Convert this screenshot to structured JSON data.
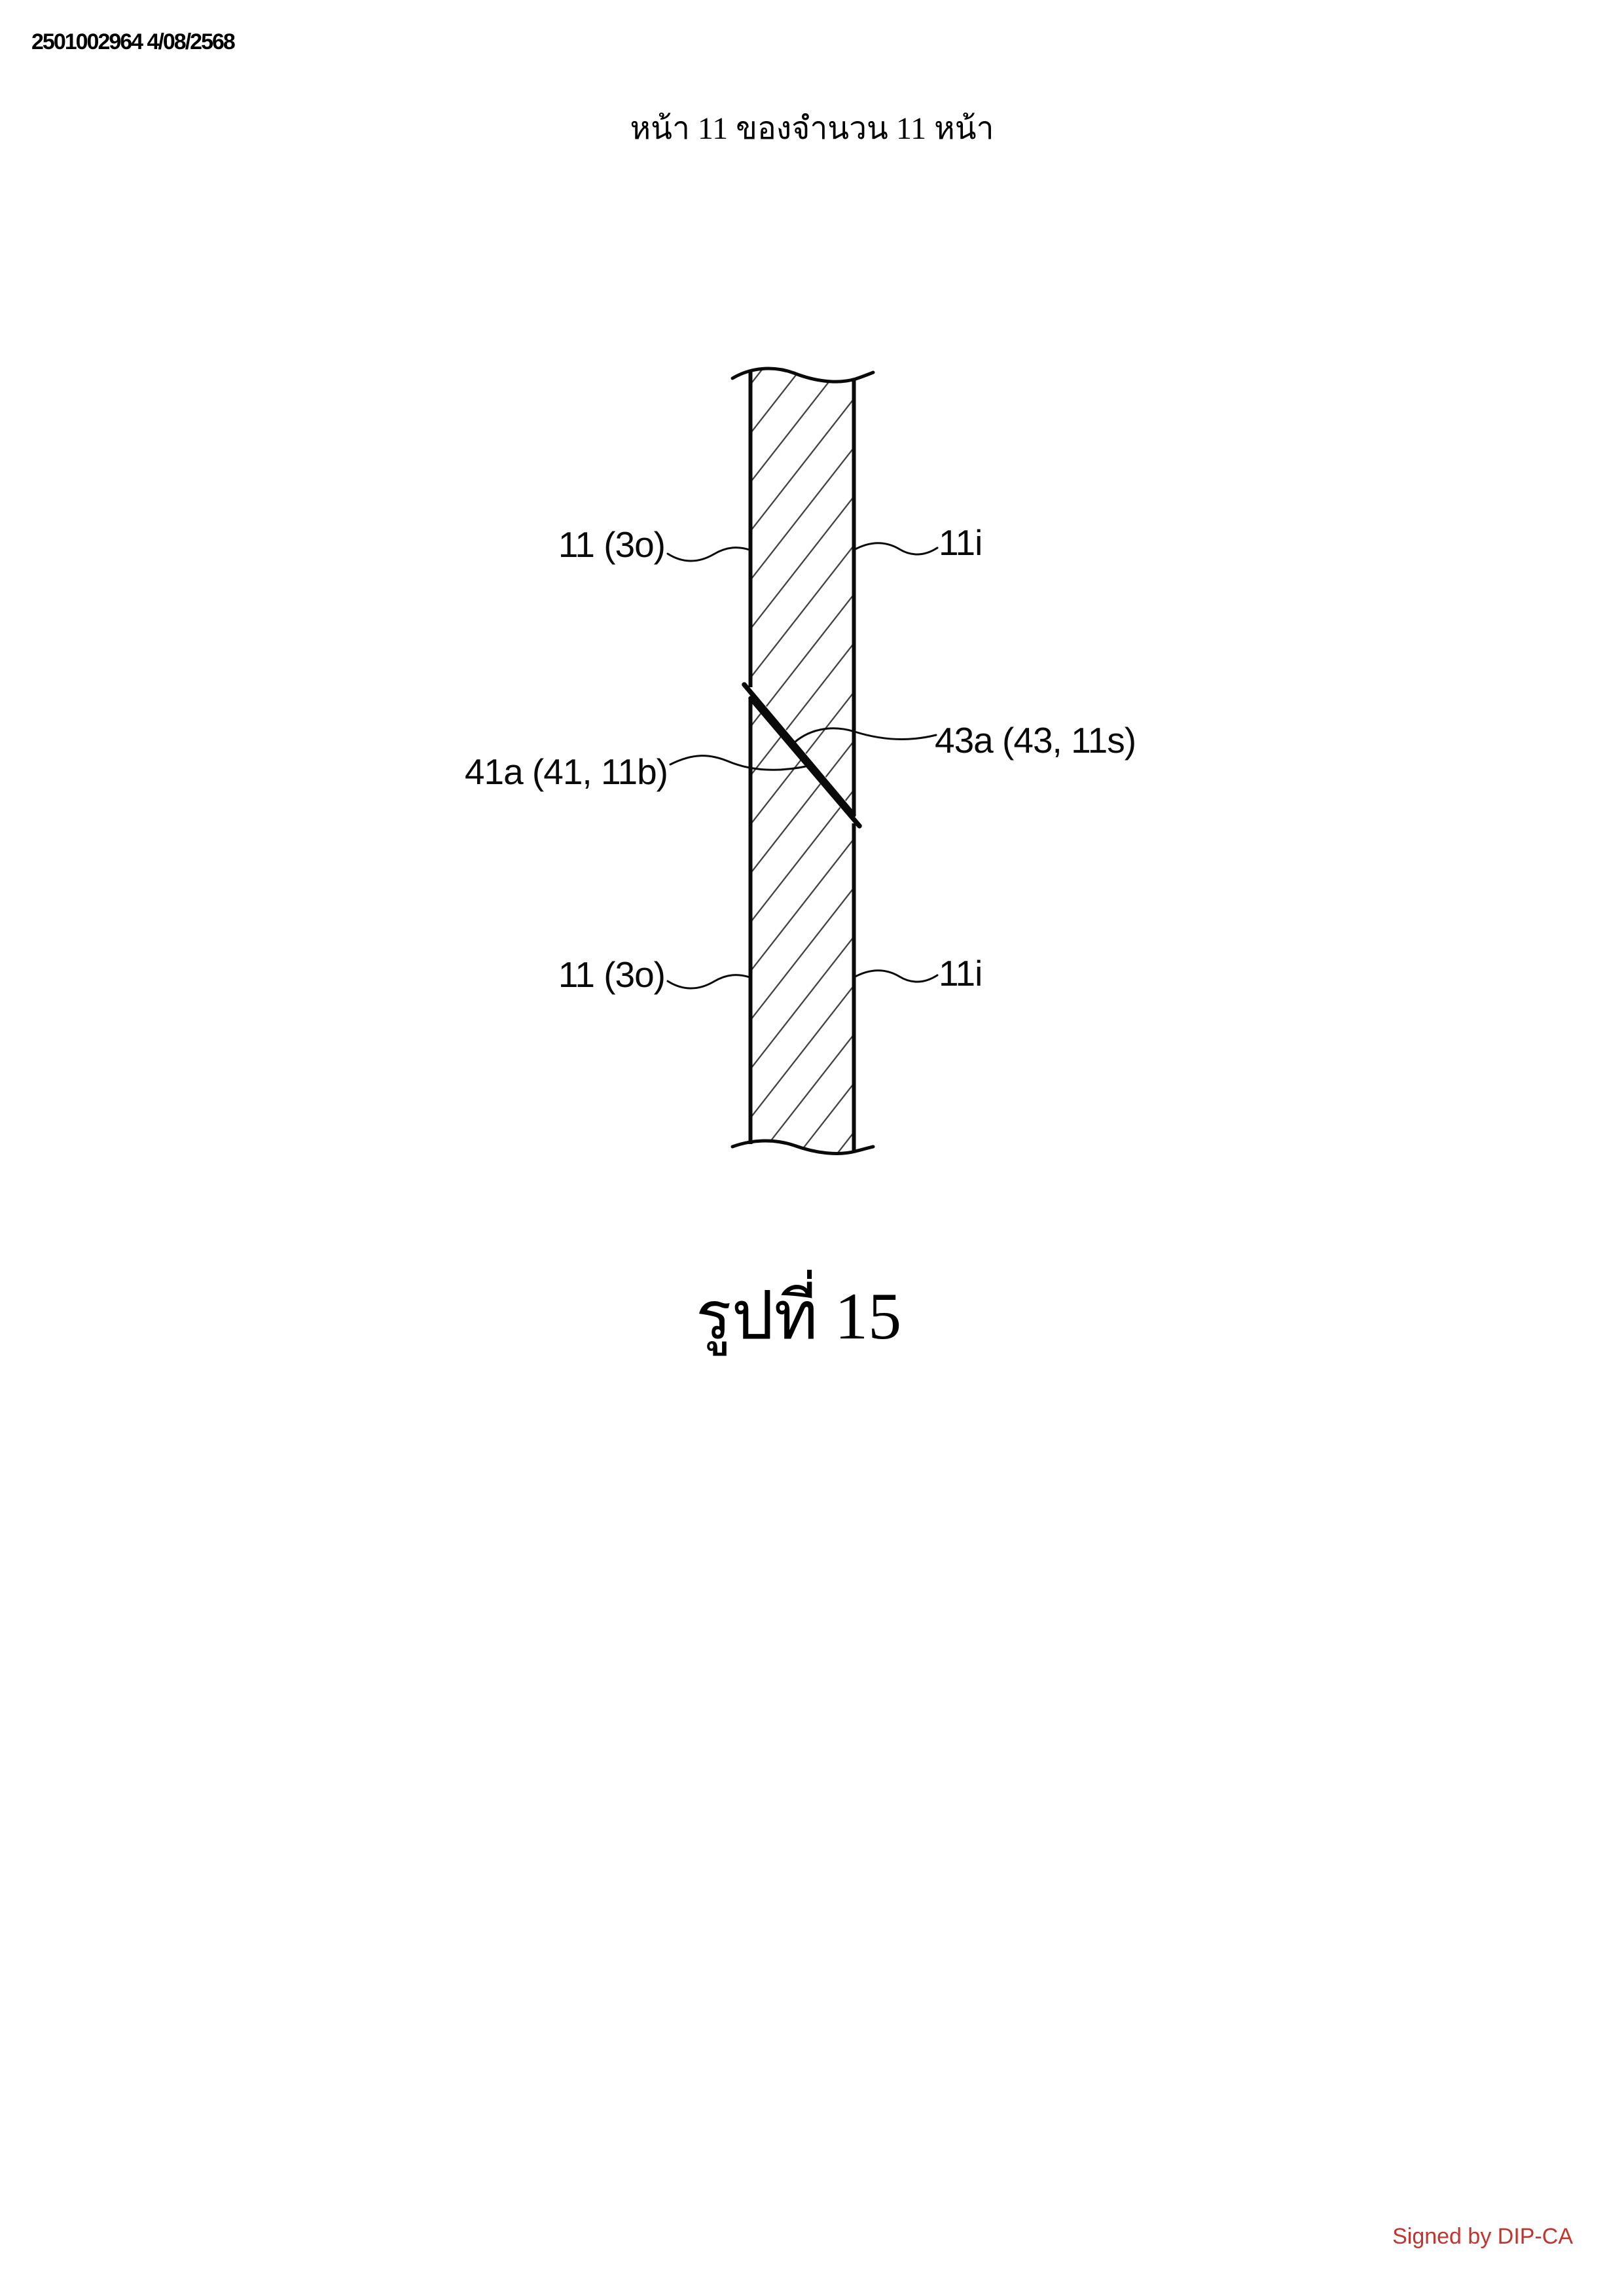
{
  "page": {
    "doc_number": "2501002964 4/08/2568",
    "page_header": "หน้า 11 ของจำนวน 11 หน้า",
    "caption": "รูปที่ 15",
    "signature": "Signed by DIP-CA",
    "signature_color": "#c2342e",
    "ink_color": "#0a0a0a"
  },
  "figure": {
    "labels": {
      "top_left": "11 (3o)",
      "top_right": "11i",
      "mid_left": "41a (41, 11b)",
      "mid_right": "43a (43, 11s)",
      "bottom_left": "11 (3o)",
      "bottom_right": "11i"
    }
  }
}
